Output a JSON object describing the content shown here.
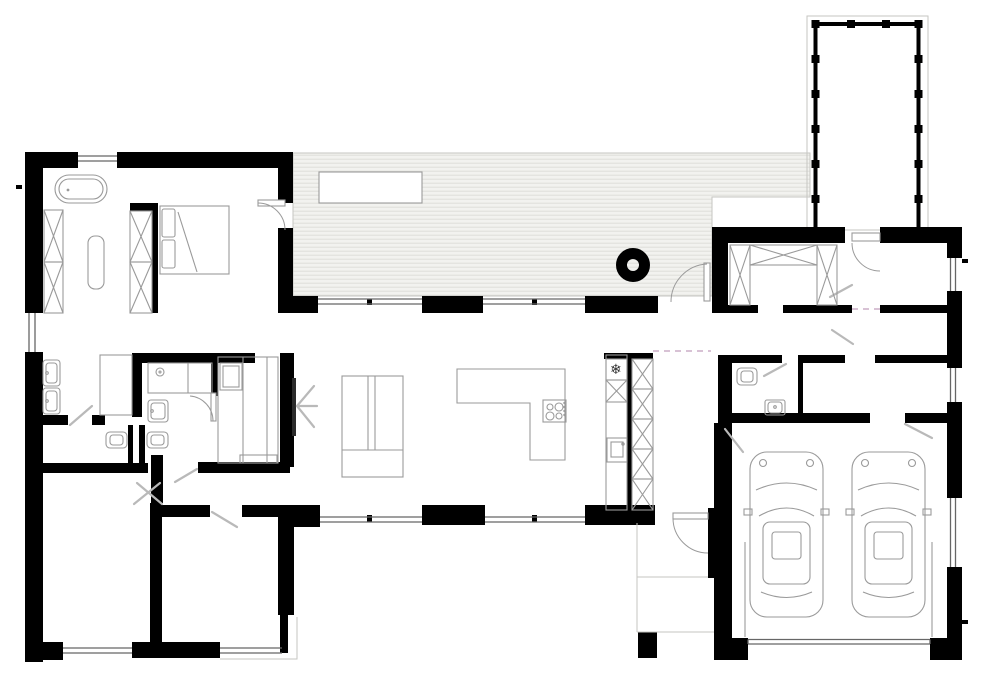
{
  "document": {
    "type": "architectural-floor-plan",
    "description": "Black-and-white single-storey house floor plan: bedroom wing on the left, striped roofed deck across the top, open living-kitchen in the centre, entry wing and double garage with two cars on the right, and a column carport driveway strip at the top right.",
    "visible_text": ""
  },
  "canvas": {
    "width": 990,
    "height": 680,
    "background": "#ffffff"
  },
  "palette": {
    "wall": "#000000",
    "fixture_line": "#9a9a9a",
    "window_line": "#666666",
    "swing_line": "#b9b9b9",
    "deck_fill": "#f2f2ef",
    "deck_stripe": "#dededa",
    "dashed_opening": "#cbadc7",
    "outline": "#c6c6c2"
  },
  "icons": {
    "snowflake": "❄"
  },
  "areas": [
    "master-bedroom",
    "master-bathroom",
    "walk-in-closet",
    "terrace-deck",
    "living-room",
    "kitchen",
    "hallway",
    "bedroom-2",
    "bedroom-3",
    "entry-mudroom",
    "entry-hall",
    "wc",
    "utility-room",
    "double-garage",
    "carport-driveway",
    "patio"
  ],
  "fixtures": [
    {
      "name": "bathtub",
      "count": 1
    },
    {
      "name": "double-bed",
      "count": 1
    },
    {
      "name": "wardrobe-x-unit",
      "count": 12
    },
    {
      "name": "bench",
      "count": 1
    },
    {
      "name": "washbasin",
      "count": 5
    },
    {
      "name": "toilet",
      "count": 3
    },
    {
      "name": "shower",
      "count": 1
    },
    {
      "name": "tv",
      "count": 1
    },
    {
      "name": "sideboard",
      "count": 1
    },
    {
      "name": "kitchen-island-with-cooktop",
      "count": 1
    },
    {
      "name": "fridge-freezer",
      "count": 1
    },
    {
      "name": "outdoor-table",
      "count": 1
    },
    {
      "name": "fire-pit",
      "count": 1
    },
    {
      "name": "car",
      "count": 2
    },
    {
      "name": "door-swing",
      "count": 12
    },
    {
      "name": "window",
      "count": 10
    }
  ]
}
